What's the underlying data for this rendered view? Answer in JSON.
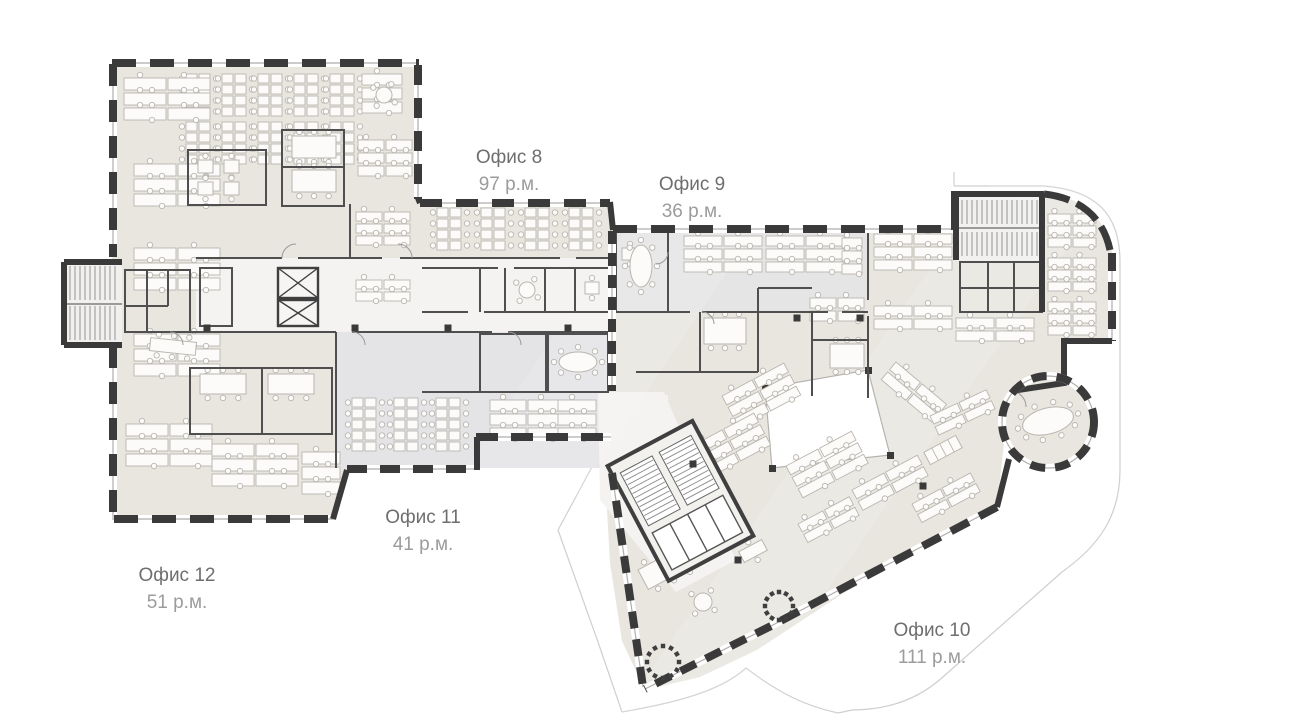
{
  "page": {
    "kind": "office floor plan",
    "background": "#ffffff"
  },
  "offices": [
    {
      "id": "office-8",
      "name": "Офис 8",
      "area": "97 р.м."
    },
    {
      "id": "office-9",
      "name": "Офис 9",
      "area": "36 р.м."
    },
    {
      "id": "office-10",
      "name": "Офис 10",
      "area": "111 р.м."
    },
    {
      "id": "office-11",
      "name": "Офис 11",
      "area": "41 р.м."
    },
    {
      "id": "office-12",
      "name": "Офис 12",
      "area": "51 р.м."
    }
  ],
  "palette": {
    "floor": "#e9e6e0",
    "floor_alt": "#e4e4e7",
    "corridor": "#f4f3f1",
    "wall": "#3a3a3a",
    "window_line": "#b0aeaa",
    "furn": "#b9b6b0",
    "label_name": "#6e6e6e",
    "label_area": "#9c9c9c"
  }
}
